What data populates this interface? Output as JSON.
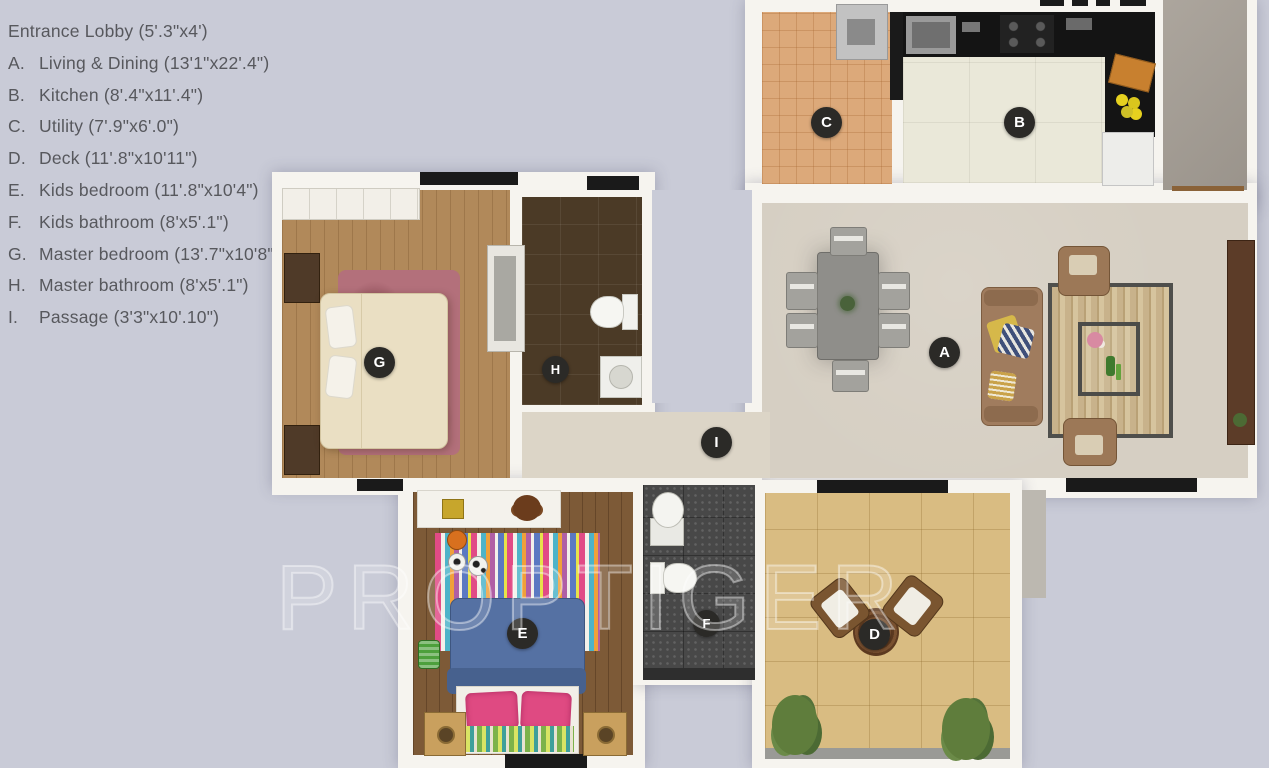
{
  "title": "2BHK apartment floor plan",
  "watermark": "PROPTIGER",
  "legend": {
    "entrance": "Entrance Lobby (5'.3\"x4')",
    "items": [
      {
        "letter": "A.",
        "text": "Living & Dining (13'1\"x22'.4\")"
      },
      {
        "letter": "B.",
        "text": "Kitchen (8'.4\"x11'.4\")"
      },
      {
        "letter": "C.",
        "text": "Utility (7'.9\"x6'.0\")"
      },
      {
        "letter": "D.",
        "text": "Deck (11'.8\"x10'11\")"
      },
      {
        "letter": "E.",
        "text": "Kids bedroom (11'.8\"x10'4\")"
      },
      {
        "letter": "F.",
        "text": "Kids bathroom (8'x5'.1\")"
      },
      {
        "letter": "G.",
        "text": "Master bedroom (13'.7\"x10'8\")"
      },
      {
        "letter": "H.",
        "text": "Master bathroom (8'x5'.1\")"
      },
      {
        "letter": "I.",
        "text": "Passage (3'3\"x10'.10\")"
      }
    ]
  },
  "markers": [
    {
      "letter": "A",
      "room": "Living & Dining"
    },
    {
      "letter": "B",
      "room": "Kitchen"
    },
    {
      "letter": "C",
      "room": "Utility"
    },
    {
      "letter": "D",
      "room": "Deck"
    },
    {
      "letter": "E",
      "room": "Kids bedroom"
    },
    {
      "letter": "F",
      "room": "Kids bathroom"
    },
    {
      "letter": "G",
      "room": "Master bedroom"
    },
    {
      "letter": "H",
      "room": "Master bathroom"
    },
    {
      "letter": "I",
      "room": "Passage"
    }
  ],
  "colors": {
    "background": "#c9cbd7",
    "wall": "#f6f4ef",
    "window": "#1a1a1a",
    "marker": "#2b2a27",
    "legend_text": "#57585d"
  }
}
